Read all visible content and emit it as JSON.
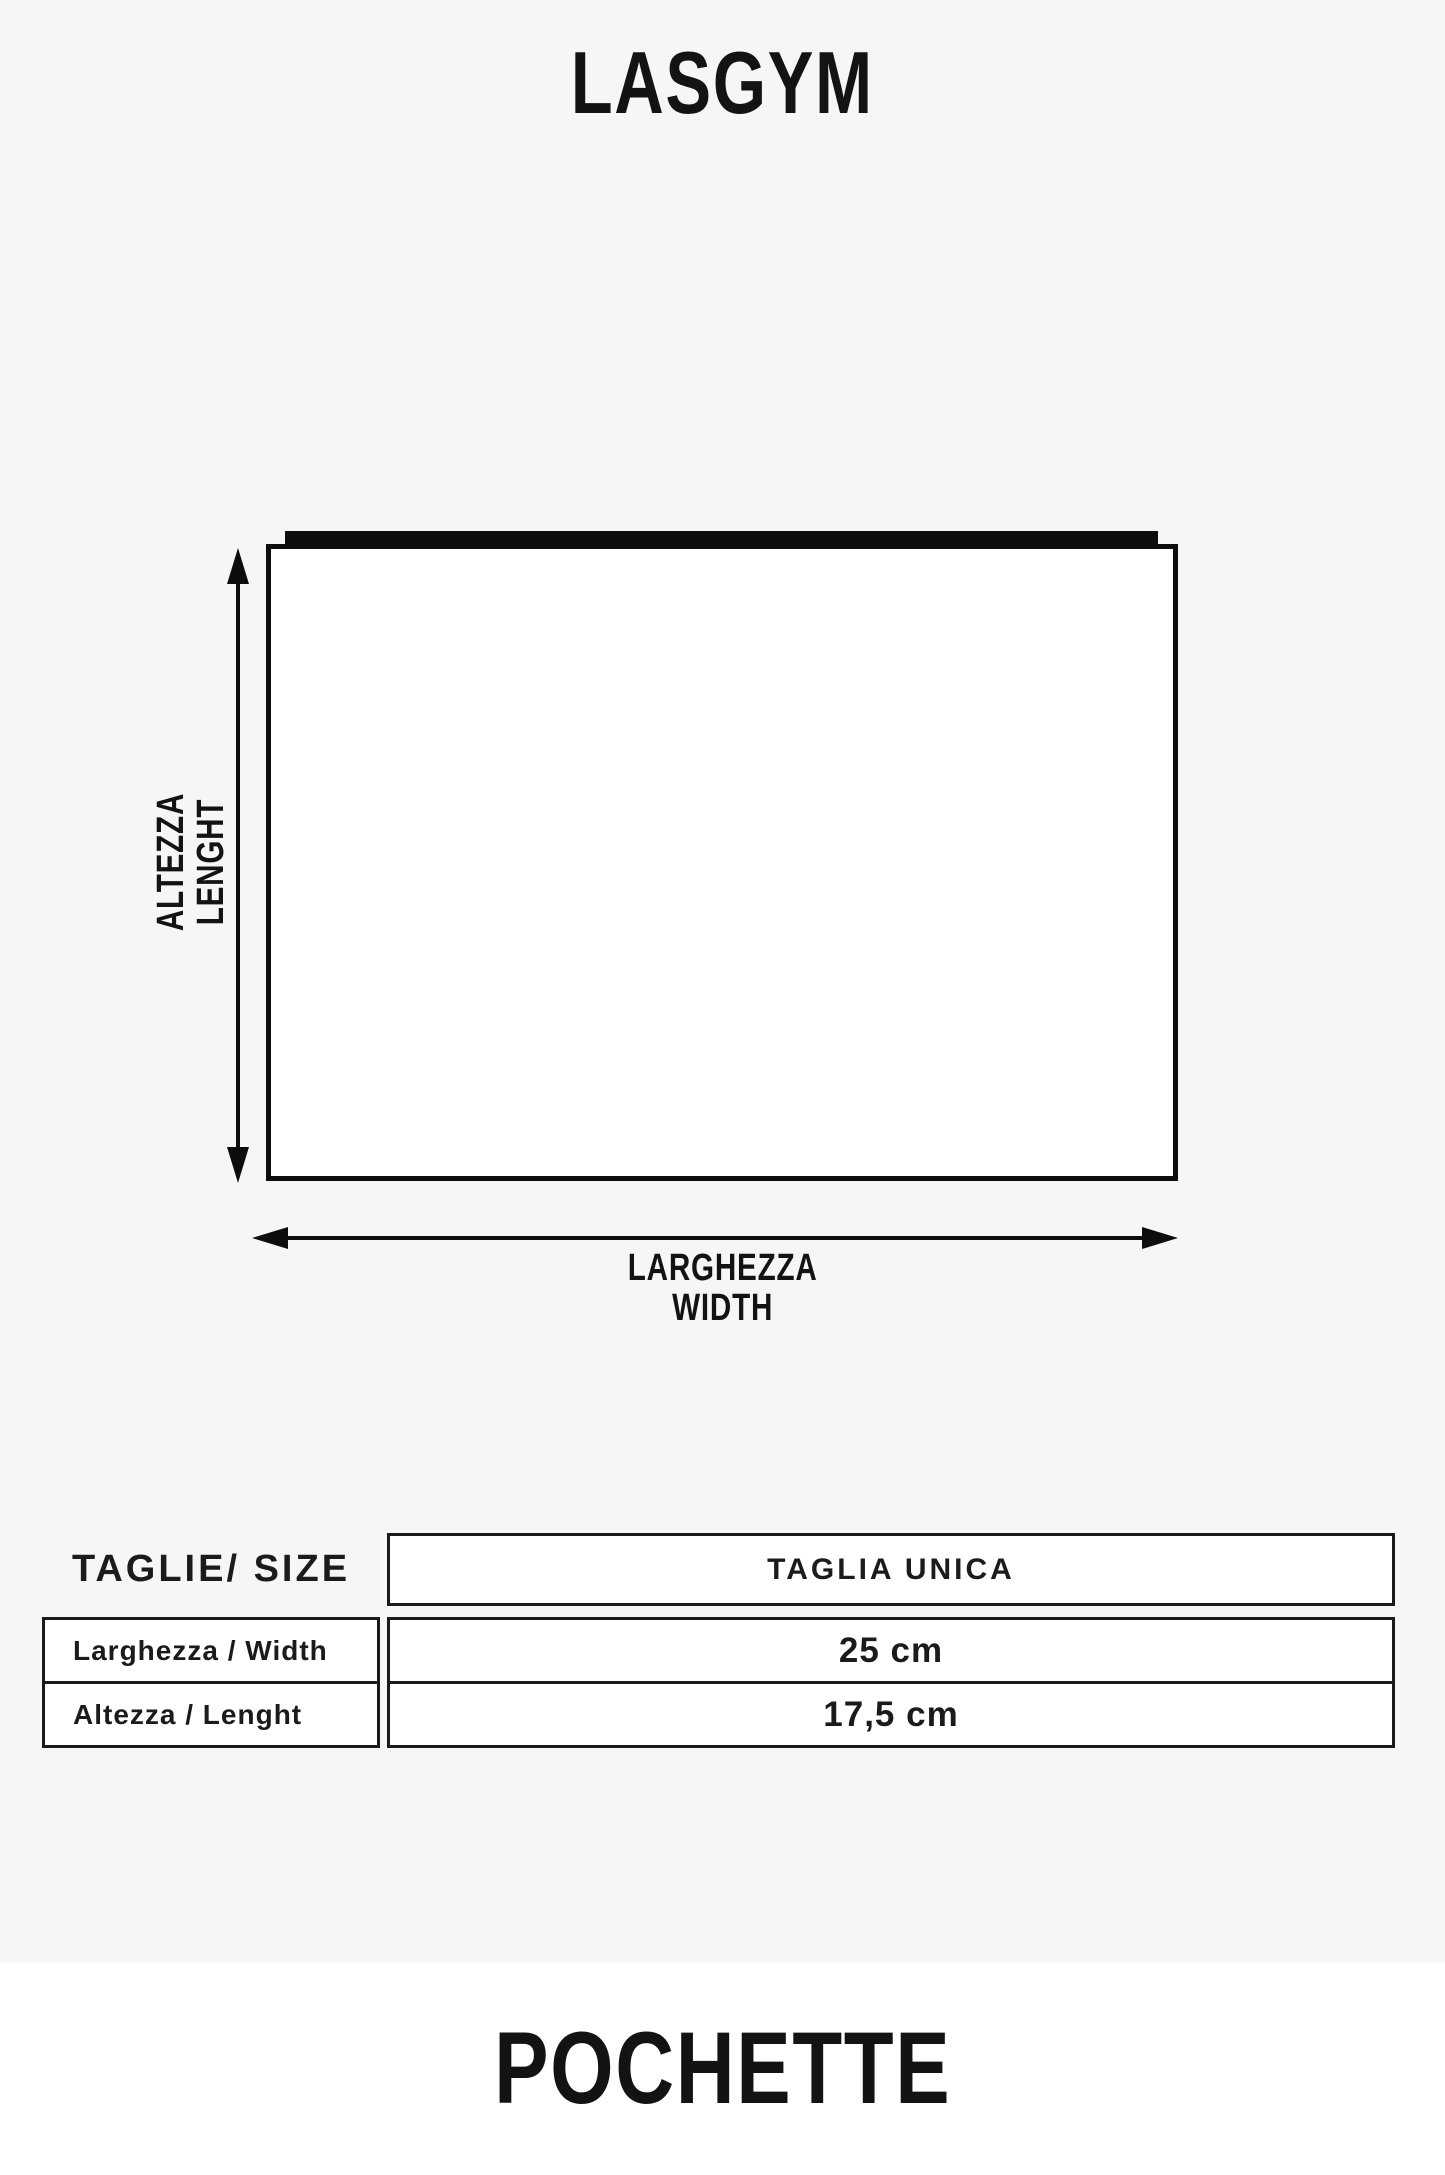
{
  "brand": "LASGYM",
  "product": "POCHETTE",
  "diagram": {
    "vertical_label_line1": "ALTEZZA",
    "vertical_label_line2": "LENGHT",
    "horizontal_label_line1": "LARGHEZZA",
    "horizontal_label_line2": "WIDTH"
  },
  "size_table": {
    "corner_label": "TAGLIE/ SIZE",
    "size_column_header": "TAGLIA UNICA",
    "rows": [
      {
        "label": "Larghezza / Width",
        "value": "25 cm"
      },
      {
        "label": "Altezza / Lenght",
        "value": "17,5 cm"
      }
    ]
  },
  "colors": {
    "background": "#f6f6f7",
    "footer_band": "#ffffff",
    "ink": "#0d0d0d",
    "cell_fill": "#ffffff"
  }
}
